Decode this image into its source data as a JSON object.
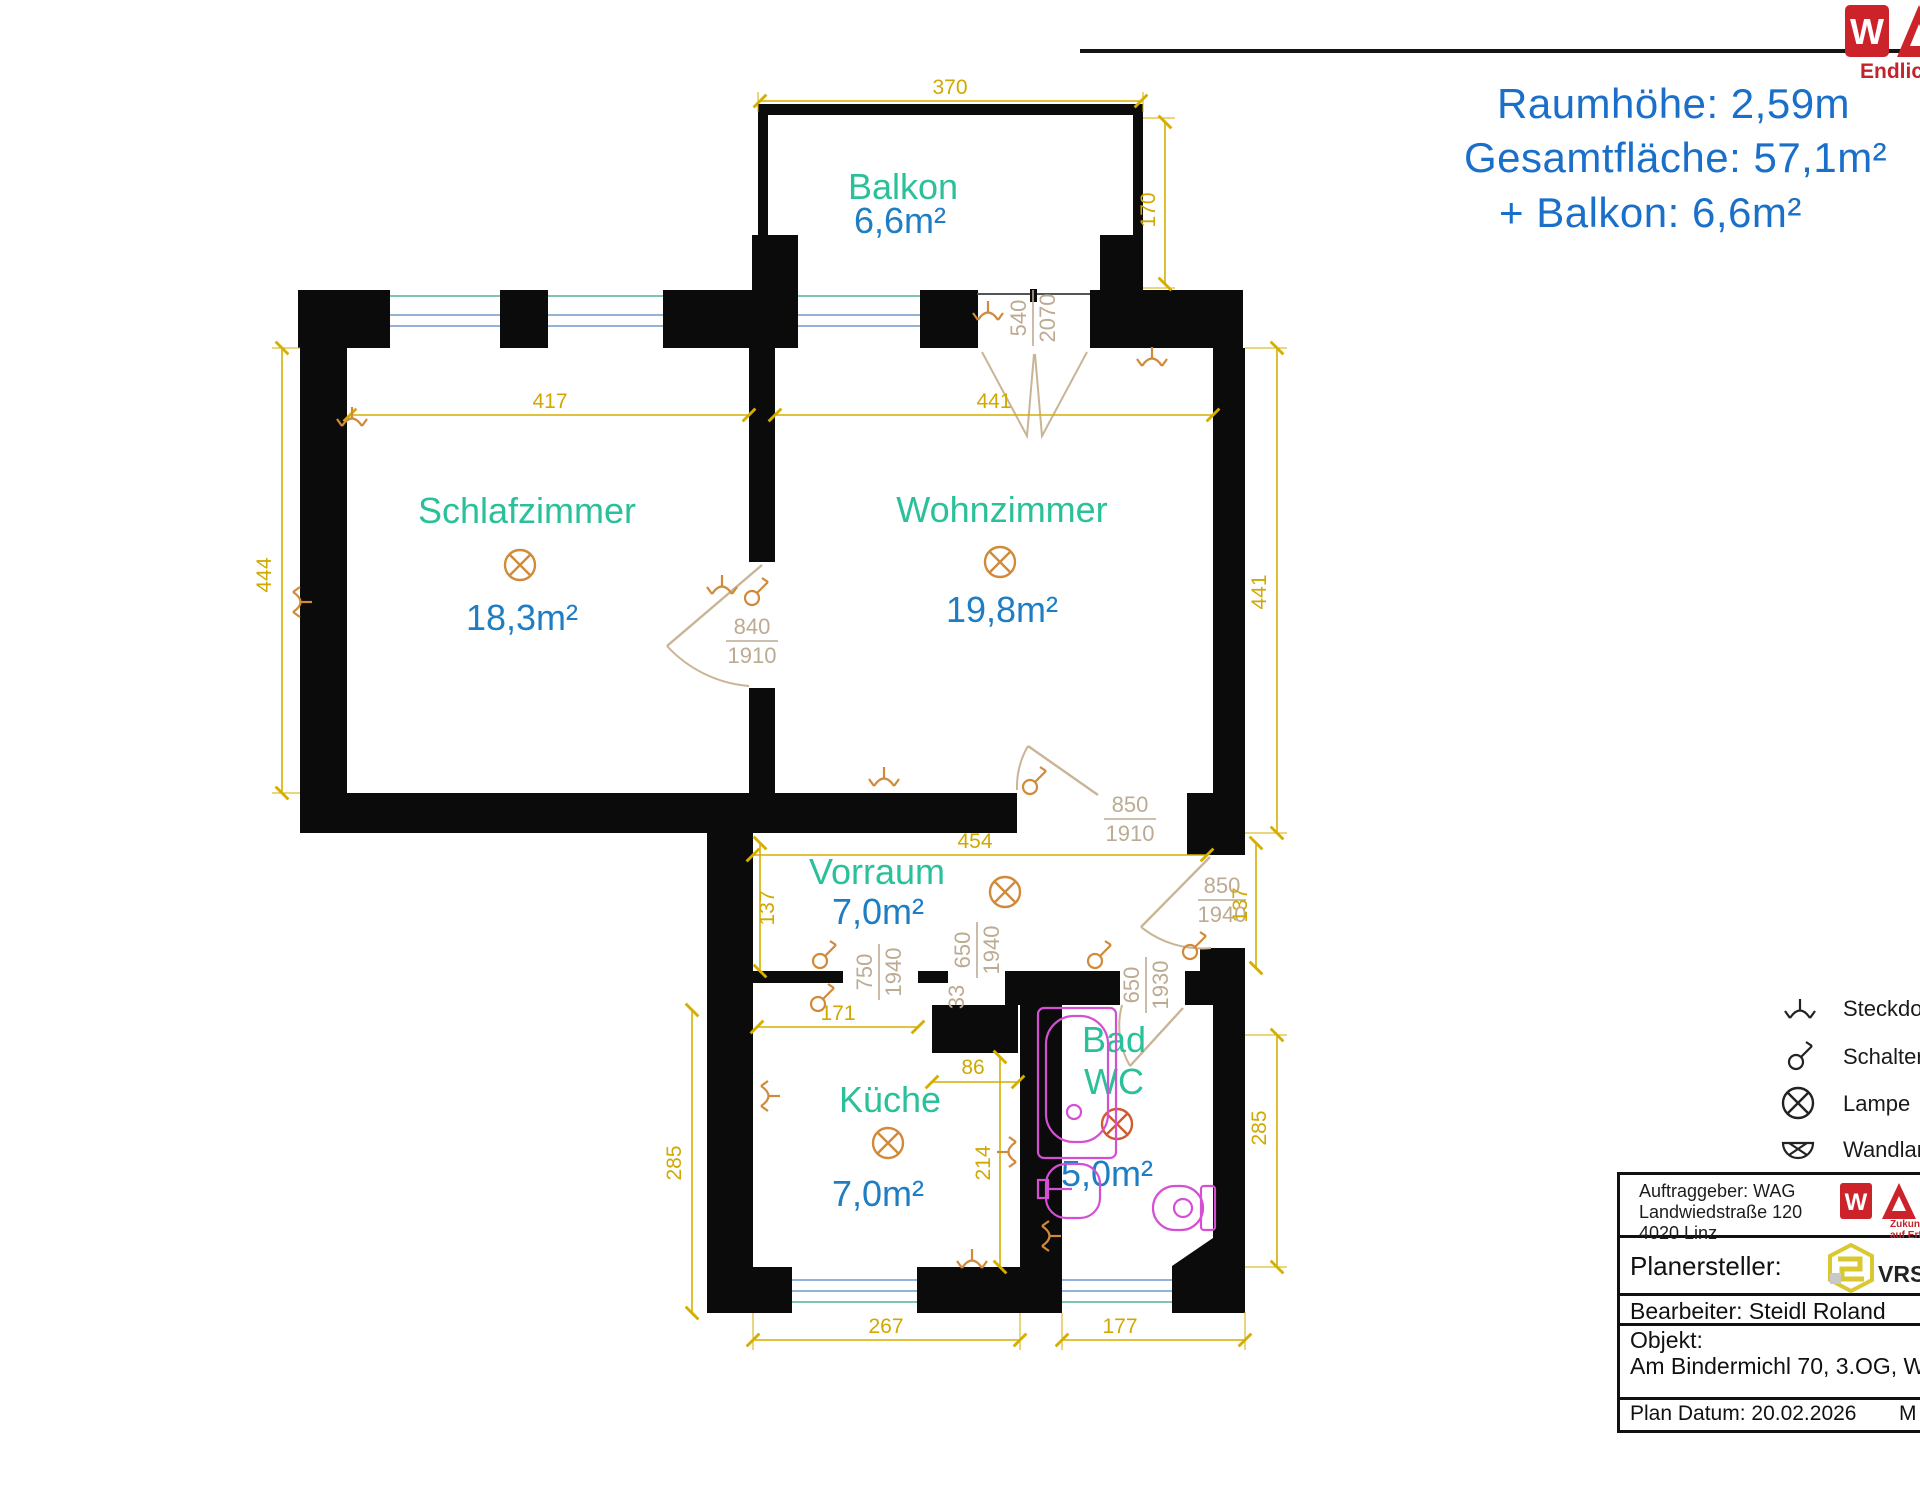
{
  "header": {
    "raumhoehe": "Raumhöhe: 2,59m",
    "gesamtflaeche": "Gesamtfläche: 57,1m²",
    "balkon_zusatz": "+ Balkon: 6,6m²"
  },
  "brand": {
    "w": "W",
    "a": "A",
    "tagline": "Endlich"
  },
  "rooms": {
    "balkon": {
      "name": "Balkon",
      "area": "6,6m²"
    },
    "schlafzimmer": {
      "name": "Schlafzimmer",
      "area": "18,3m²"
    },
    "wohnzimmer": {
      "name": "Wohnzimmer",
      "area": "19,8m²"
    },
    "vorraum": {
      "name": "Vorraum",
      "area": "7,0m²"
    },
    "kueche": {
      "name": "Küche",
      "area": "7,0m²"
    },
    "bad": {
      "name_line1": "Bad",
      "name_line2": "WC",
      "area": "5,0m²"
    }
  },
  "dims": {
    "balkon_width": "370",
    "balkon_depth": "170",
    "schlaf_width": "417",
    "schlaf_height": "444",
    "wohn_width": "441",
    "wohn_height": "441",
    "vorraum_width": "454",
    "vorraum_left": "137",
    "vorraum_right": "137",
    "kueche_top": "171",
    "nische": "86",
    "kueche_right": "214",
    "kueche_width": "267",
    "bad_width": "177",
    "kueche_height": "285",
    "bad_height": "285"
  },
  "doors": {
    "balkontuer_w": "540",
    "balkontuer_h": "2070",
    "schlaftuer_w": "840",
    "schlaftuer_h": "1910",
    "wohntuer_w": "850",
    "wohntuer_h": "1910",
    "eingang_w": "850",
    "eingang_h": "1940",
    "kuechentuer_w": "750",
    "kuechentuer_h": "1940",
    "pfeiler": "33",
    "durchgang_w": "650",
    "durchgang_h": "1940",
    "badtuer_w": "650",
    "badtuer_h": "1930"
  },
  "legend": {
    "steckdose": "Steckdose",
    "schalter": "Schalter",
    "lampe": "Lampe",
    "wandlampe": "Wandlampe"
  },
  "titleblock": {
    "auftraggeber": "Auftraggeber: WAG",
    "adresse1": "Landwiedstraße 120",
    "adresse2": "4020 Linz",
    "wag_tag1": "Zukunf",
    "wag_tag2": "auf Erfa",
    "planersteller": "Planersteller:",
    "vr": "VRSt",
    "bearbeiter": "Bearbeiter: Steidl Roland",
    "objekt_label": "Objekt:",
    "objekt": "Am Bindermichl 70, 3.OG, WG 7",
    "datum": "Plan Datum: 20.02.2026",
    "massstab": "M"
  },
  "colors": {
    "room_name_green": "#2ac09a",
    "area_blue": "#1f7dc4",
    "header_blue": "#1a6fc9",
    "dimension_yellow": "#d6ae00",
    "door_label_tan": "#bcab92",
    "symbol_orange": "#d08a3a",
    "fixture_magenta": "#d44fd4",
    "brand_red": "#cc2229",
    "wall_black": "#0b0b0b"
  }
}
